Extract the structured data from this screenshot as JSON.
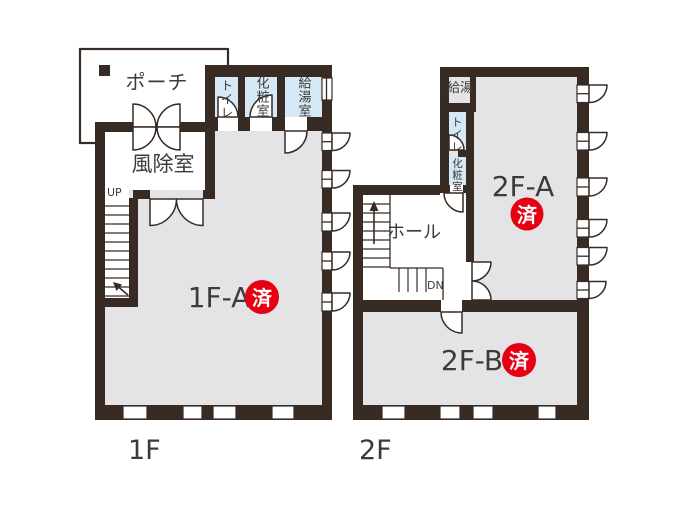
{
  "palette": {
    "wall": "#382b24",
    "floor": "#e4e4e6",
    "wet_room": "#d4e9f5",
    "accent_red": "#e60012",
    "ink": "#3e3a39",
    "paper": "#ffffff"
  },
  "floor1": {
    "floor_label": "1F",
    "porch": {
      "label": "ポーチ"
    },
    "windbreak": {
      "label": "風除室"
    },
    "toilet": {
      "label": "トイレ"
    },
    "powder_room": {
      "label": "化粧室"
    },
    "kitchenette": {
      "label": "給湯室"
    },
    "main_room": {
      "label": "1F-A",
      "status": "済"
    },
    "stairs": {
      "label": "UP"
    }
  },
  "floor2": {
    "floor_label": "2F",
    "hot_water": {
      "label": "給湯"
    },
    "toilet": {
      "label": "トイレ"
    },
    "powder_room": {
      "label": "化粧室"
    },
    "hall": {
      "label": "ホール"
    },
    "room_a": {
      "label": "2F-A",
      "status": "済"
    },
    "room_b": {
      "label": "2F-B",
      "status": "済"
    },
    "stairs": {
      "label": "DN"
    }
  }
}
